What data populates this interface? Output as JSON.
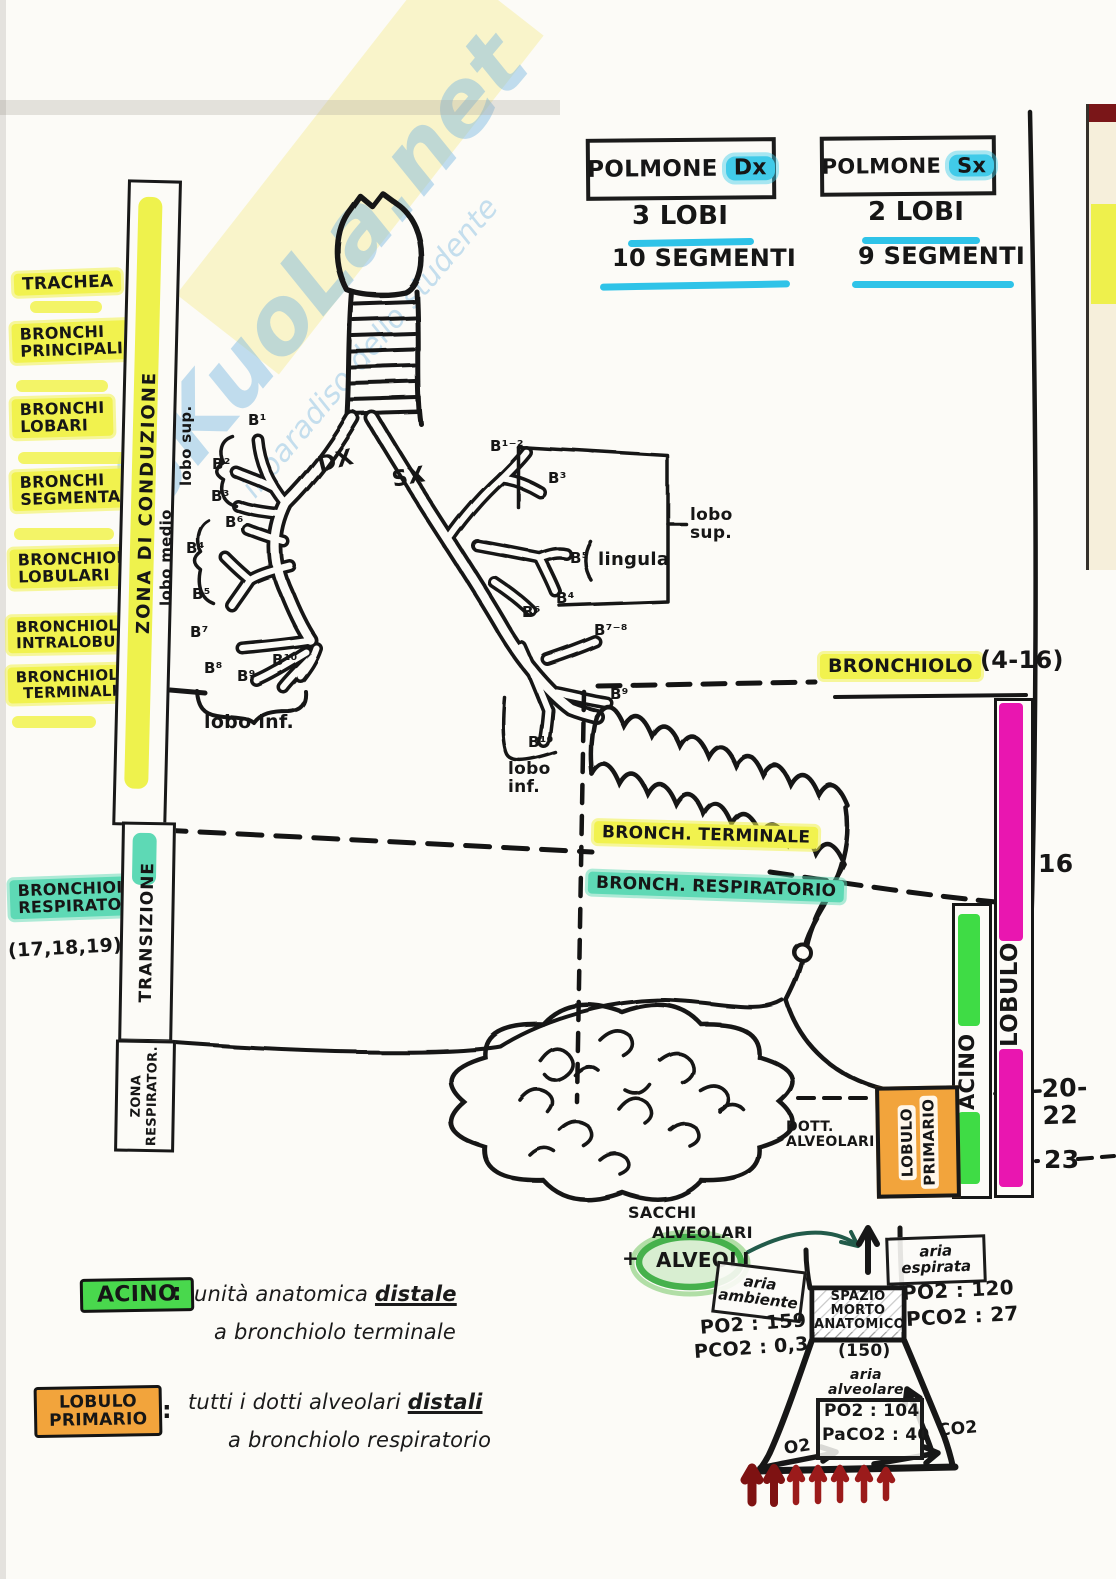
{
  "watermark": {
    "brand": "SKuoLa.net",
    "tagline": "il paradiso dello studente"
  },
  "header": {
    "right": {
      "name": "POLMONE",
      "side": "Dx",
      "lobes": "3 LOBI",
      "segments": "10 SEGMENTI"
    },
    "left": {
      "name": "POLMONE",
      "side": "Sx",
      "lobes": "2 LOBI",
      "segments": "9 SEGMENTI"
    }
  },
  "sidebar": {
    "items": [
      "TRACHEA",
      "BRONCHI\nPRINCIPALI",
      "BRONCHI\nLOBARI",
      "BRONCHI\nSEGMENTALI",
      "BRONCHIOLI\nLOBULARI",
      "BRONCHIOLI\nINTRALOBULARI",
      "BRONCHIOLI\nTERMINALI"
    ],
    "respiratory": "BRONCHIOLI\nRESPIRATORI",
    "respiratory_generations": "(17,18,19)"
  },
  "zones": {
    "conduction": "ZONA DI CONDUZIONE",
    "transition": "TRANSIZIONE",
    "respiratory_1": "ZONA",
    "respiratory_2": "RESPIRATOR."
  },
  "tree": {
    "dx": "DX",
    "sx": "SX",
    "right": {
      "b1": "B¹",
      "b2": "B²",
      "b3": "B³",
      "b4": "B⁴",
      "b5": "B⁵",
      "b6": "B⁶",
      "b7": "B⁷",
      "b8": "B⁸",
      "b9": "B⁹",
      "b10": "B¹⁰",
      "lobo_sup": "lobo sup.",
      "lobo_medio": "lobo medio",
      "lobo_inf": "lobo inf."
    },
    "left": {
      "b12": "B¹⁻²",
      "b3": "B³",
      "b4": "B⁴",
      "b5": "B⁵",
      "b6": "B⁶",
      "b78": "B⁷⁻⁸",
      "b9": "B⁹",
      "b10": "B¹⁰",
      "lingula": "lingula",
      "lobo_sup": "lobo\nsup.",
      "lobo_inf": "lobo\ninf."
    }
  },
  "levels": {
    "bronchiolo": "BRONCHIOLO",
    "bronchiolo_range": "(4-16)",
    "gen_16": "16",
    "bronch_terminale": "BRONCH. TERMINALE",
    "bronch_respiratorio": "BRONCH. RESPIRATORIO",
    "gen_20_22": "20-22",
    "gen_23": "23",
    "lobulo": "LOBULO",
    "acino": "ACINO",
    "lobulo_primario_1": "LOBULO",
    "lobulo_primario_2": "PRIMARIO",
    "dotti_alveolari": "DOTT.\nALVEOLARI"
  },
  "definitions": {
    "acino": {
      "term": "ACINO",
      "colon": ":",
      "text": "unità anatomica",
      "underlined": "distale",
      "line2": "a bronchiolo terminale"
    },
    "lobulo_primario": {
      "term": "LOBULO\nPRIMARIO",
      "colon": ":",
      "text": "tutti i dotti alveolari",
      "underlined": "distali",
      "line2": "a bronchiolo respiratorio"
    }
  },
  "gas": {
    "sacchi": "SACCHI",
    "alveolari": "ALVEOLARI",
    "plus": "+",
    "alveoli": "ALVEOLI",
    "aria_ambiente": "aria\nambiente",
    "ambiente_po2": "PO2 : 159",
    "ambiente_pco2": "PCO2 : 0,3",
    "spazio_morto": "SPAZIO\nMORTO\nANATOMICO",
    "spazio_volume": "(150)",
    "aria_espirata": "aria\nespirata",
    "espirata_po2": "PO2 : 120",
    "espirata_pco2": "PCO2 : 27",
    "aria_alveolare": "aria\nalveolare",
    "alveolare_po2": "PO2 : 104",
    "alveolare_paco2": "PaCO2 : 40",
    "o2": "O2",
    "co2": "CO2"
  }
}
